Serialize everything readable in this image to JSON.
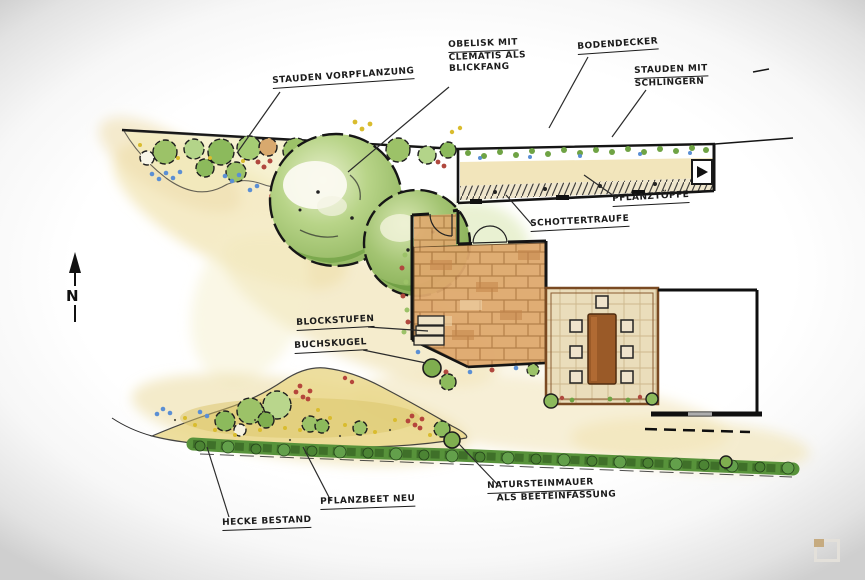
{
  "title": "Hand-drawn garden landscape plan",
  "labels": {
    "stauden_vorpflanzung": "STAUDEN VORPFLANZUNG",
    "obelisk_l1": "OBELISK MIT",
    "obelisk_l2": "CLEMATIS ALS",
    "obelisk_l3": "BLICKFANG",
    "bodendecker": "BODENDECKER",
    "stauden_mit_l1": "STAUDEN MIT",
    "stauden_mit_l2": "SCHLINGERN",
    "pflanztoepfe": "PFLANZTÖPFE",
    "schottertraufe": "SCHOTTERTRAUFE",
    "blockstufen": "BLOCKSTUFEN",
    "buchskugel": "BUCHSKUGEL",
    "natursteinmauer_l1": "NATURSTEINMAUER",
    "natursteinmauer_l2": "ALS BEETEINFASSUNG",
    "pflanzbeet_neu": "PFLANZBEET NEU",
    "hecke_bestand": "HECKE BESTAND"
  },
  "compass": {
    "letter": "N"
  },
  "colors": {
    "paper": "#ffffff",
    "vignette": "#cfcfcf",
    "ink": "#1b1b1b",
    "foliage": "#8cba5c",
    "brick": "#dda56b",
    "hedge": "#4f8a38",
    "ground_wash": "#f0e2b0",
    "flower_red": "#b0483e",
    "flower_blue": "#5b8fd4"
  },
  "icons": {
    "north_arrow": "north-arrow",
    "watermark": "gallery-icon"
  }
}
